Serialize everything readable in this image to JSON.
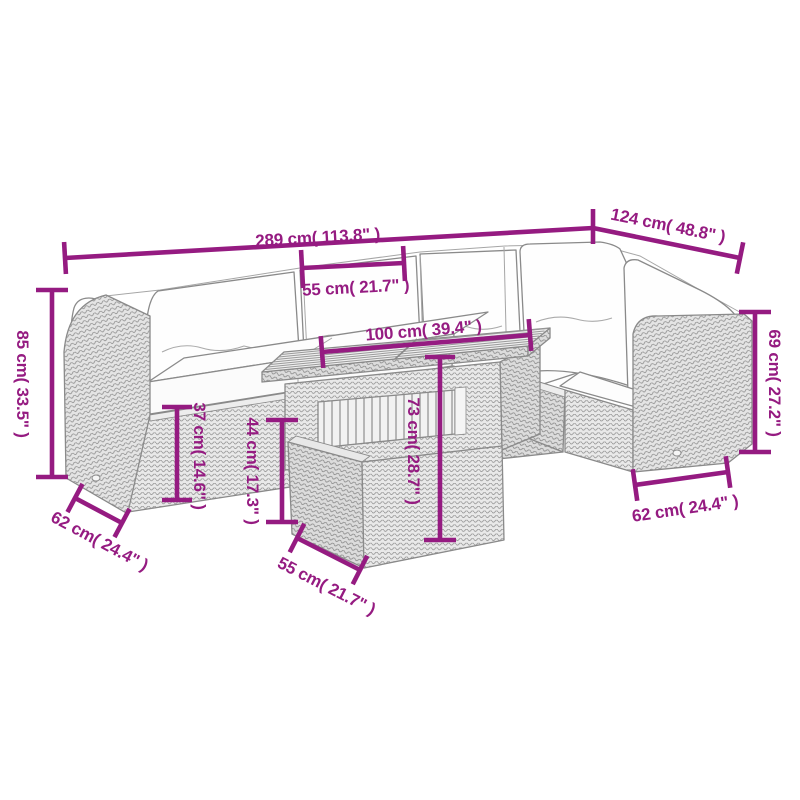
{
  "diagram": {
    "kind": "furniture dimension line drawing",
    "scene": "garden lounge set with corner sofa, slatted table and cube stool"
  },
  "colors": {
    "dimension_magenta": "#951b81",
    "outline_grey": "#8a8a8a",
    "background": "#ffffff"
  },
  "dimensions": {
    "top_main": "289 cm( 113.8\" )",
    "top_right": "124 cm( 48.8\" )",
    "top_middle": "55 cm( 21.7\" )",
    "table_top": "100 cm( 39.4\" )",
    "left_vertical": "85 cm( 33.5\" )",
    "right_vertical": "69 cm( 27.2\" )",
    "mid_left_vertical": "37 cm( 14.6\" )",
    "mid_center_vertical": "44 cm( 17.3\" )",
    "table_vertical": "73 cm( 28.7\" )",
    "bottom_left": "62 cm( 24.4\" )",
    "bottom_middle": "55 cm( 21.7\" )",
    "bottom_right": "62 cm( 24.4\" )"
  }
}
